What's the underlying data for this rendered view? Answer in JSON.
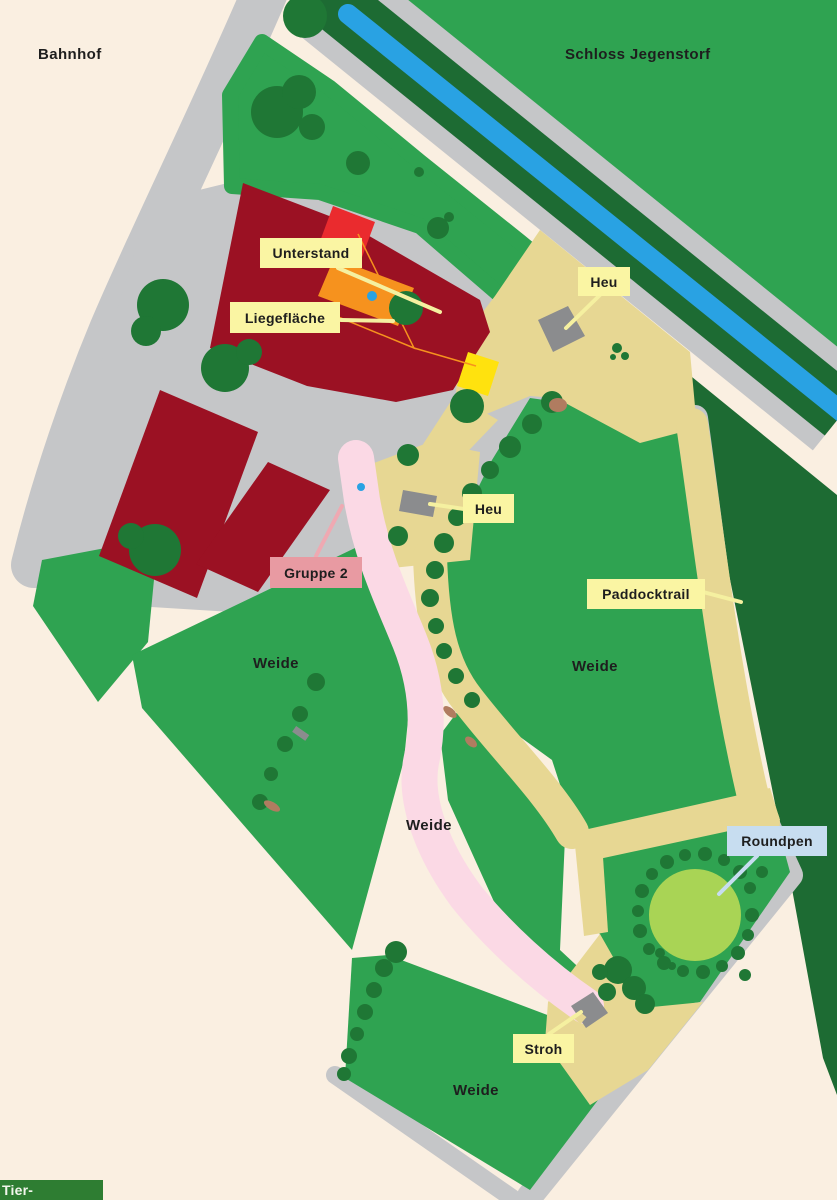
{
  "map": {
    "area_labels": {
      "bahnhof": "Bahnhof",
      "schloss": "Schloss Jegenstorf",
      "weide_left": "Weide",
      "weide_center": "Weide",
      "weide_middle": "Weide",
      "weide_bottom": "Weide"
    },
    "feature_labels": {
      "unterstand": "Unterstand",
      "liegeflaeche": "Liegefläche",
      "heu_north": "Heu",
      "heu_west": "Heu",
      "gruppe2": "Gruppe 2",
      "paddocktrail": "Paddocktrail",
      "roundpen": "Roundpen",
      "stroh": "Stroh"
    },
    "colors": {
      "bg": "#FAEFE1",
      "road": "#C5C6C8",
      "field": "#2FA351",
      "forest": "#1D6B33",
      "tree": "#1F7735",
      "stream": "#29A2E3",
      "building": "#9B1123",
      "redbox": "#EA2B2E",
      "orange": "#F6921E",
      "yellowbox": "#FFE20E",
      "trail": "#E7D793",
      "pink": "#FBD9E5",
      "labelyellow": "#FAF5A3",
      "labelpink": "#E89AA2",
      "labelblue": "#C7DDF0",
      "leaderyellow": "#F5F0A0",
      "leaderpink": "#EFA9B2",
      "roundpen": "#A9D455",
      "feeder": "#8B8C8E",
      "dirt": "#B07C60",
      "wmgreen": "#2E7D32",
      "text": "#1E1E1E"
    }
  },
  "watermark": {
    "text": "Tier-Inserate.ch"
  }
}
